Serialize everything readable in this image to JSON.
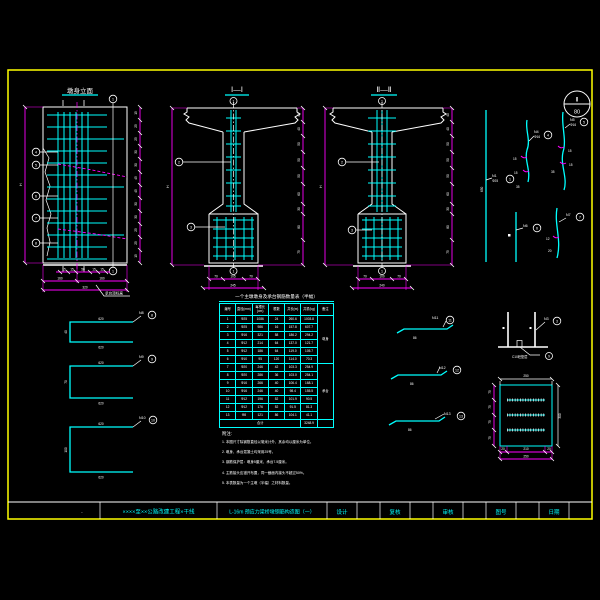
{
  "sheet": {
    "project": "××××至××公路改建工程×干线",
    "drawing_title": "L-16m 预应力梁桥墩钢筋构造图（一）",
    "fields": {
      "design": "设计",
      "check": "复核",
      "review": "审核",
      "fig_no": "图号",
      "date": "日期"
    },
    "corner_dot": "·",
    "detail_bubble": {
      "top": "Ⅱ",
      "bottom": "80"
    }
  },
  "elevation": {
    "title": "墩身立面",
    "height_label": "H",
    "callouts": [
      "4",
      "5",
      "6",
      "7",
      "8"
    ],
    "bar_circle": "1",
    "right_dims": [
      "15",
      "25",
      "25",
      "30",
      "30",
      "45",
      "45",
      "30",
      "30",
      "25",
      "25",
      "15"
    ],
    "bottom_dims_1": [
      "15",
      "15",
      "50",
      "15",
      "15"
    ],
    "bottom_dims_2": [
      "160",
      "160"
    ],
    "bottom_total": "320",
    "leader_note": "承台顶标高"
  },
  "section1": {
    "title": "Ⅰ—Ⅰ",
    "top_circle": "1",
    "bottom_circle": "1",
    "callout_column": "2",
    "callout_footing": "3",
    "height_label": "H",
    "right_dims": [
      "40",
      "40",
      "50",
      "50",
      "50",
      "60",
      "30",
      "80",
      "75"
    ],
    "bottom_dims": [
      "70",
      "105",
      "70"
    ],
    "bottom_total": "245"
  },
  "section2": {
    "title": "Ⅱ—Ⅱ",
    "top_circle": "1",
    "bottom_circle": "1",
    "callout_column": "2",
    "callout_footing": "3",
    "height_label": "H",
    "right_dims": [
      "40",
      "40",
      "50",
      "50",
      "50",
      "60",
      "30",
      "80",
      "75"
    ],
    "bottom_dims": [
      "70",
      "100",
      "70"
    ],
    "bottom_total": "240"
  },
  "bar_shapes": {
    "long_bar": {
      "name": "N1",
      "size": "Φ25",
      "length": "650",
      "num": "1"
    },
    "s_bar_1": {
      "name": "N4",
      "size": "Φ16",
      "num": "4",
      "hook1": "15",
      "hook2": "15",
      "seg": "35"
    },
    "s_bar_2": {
      "name": "N5",
      "size": "Φ16",
      "num": "5",
      "hook1": "15",
      "hook2": "15",
      "seg": "35"
    },
    "v_bar": {
      "name": "N6",
      "num": "6"
    },
    "c_bar": {
      "name": "N7",
      "num": "7",
      "dim1": "12",
      "dim2": "20"
    },
    "stirrup": {
      "name": "N3",
      "num": "3",
      "note": "C10砼垫层",
      "note_num": "9"
    },
    "hairpins": [
      {
        "name": "N8",
        "num": "8",
        "top": "620",
        "bottom": "620",
        "side": "40"
      },
      {
        "name": "N9",
        "num": "9",
        "top": "620",
        "bottom": "620",
        "side": "70"
      },
      {
        "name": "N10",
        "num": "10",
        "top": "620",
        "bottom": "620",
        "side": "100"
      }
    ],
    "flat_bars": [
      {
        "name": "N11",
        "num": "11",
        "dim": "86"
      },
      {
        "name": "N12",
        "num": "12",
        "dim": "86"
      },
      {
        "name": "N13",
        "num": "13",
        "dim": "86"
      }
    ]
  },
  "plan": {
    "top_dim": "250",
    "right_dim": "300",
    "left_dims": [
      "75",
      "75",
      "75",
      "75"
    ],
    "bottom_dims": [
      "20",
      "210",
      "20"
    ],
    "bottom_total": "250"
  },
  "table": {
    "title": "一个主墩墩身及承台钢筋数量表（半幅）",
    "headers": [
      "编号",
      "直径(mm)",
      "每根长(cm)",
      "根数",
      "共长(m)",
      "共重(kg)",
      "备注"
    ],
    "rows": [
      [
        "1",
        "Φ25",
        "1086",
        "24",
        "260.6",
        "1003.8"
      ],
      [
        "2",
        "Φ25",
        "986",
        "16",
        "157.8",
        "607.7"
      ],
      [
        "3",
        "Φ16",
        "321",
        "58",
        "186.2",
        "294.2"
      ],
      [
        "4",
        "Φ12",
        "214",
        "64",
        "137.0",
        "121.7"
      ],
      [
        "5",
        "Φ12",
        "186",
        "64",
        "119.0",
        "105.7"
      ],
      [
        "6",
        "Φ10",
        "95",
        "120",
        "114.0",
        "70.3"
      ],
      [
        "7",
        "Φ20",
        "246",
        "42",
        "103.3",
        "254.9"
      ],
      [
        "8",
        "Φ20",
        "286",
        "36",
        "103.0",
        "254.1"
      ],
      [
        "9",
        "Φ16",
        "266",
        "40",
        "106.4",
        "168.1"
      ],
      [
        "10",
        "Φ16",
        "246",
        "40",
        "98.4",
        "155.5"
      ],
      [
        "11",
        "Φ12",
        "196",
        "52",
        "101.9",
        "90.5"
      ],
      [
        "12",
        "Φ12",
        "176",
        "52",
        "91.5",
        "81.3"
      ],
      [
        "13",
        "Φ8",
        "121",
        "86",
        "104.1",
        "41.1"
      ]
    ],
    "remarks": [
      {
        "text": "墩身",
        "span": 6
      },
      {
        "text": "承台",
        "span": 7
      }
    ],
    "total_label": "合计",
    "total_value": "3248.9"
  },
  "notes": {
    "label": "附注:",
    "items": [
      "1. 本图尺寸除钢筋直径以毫米计外，其余均以厘米为单位。",
      "2. 墩身、承台混凝土均采用25号。",
      "3. 钢筋保护层：墩身5厘米，承台7.5厘米。",
      "4. 主筋接头应错开布置，同一截面内接头不超过50%。",
      "5. 本表数量为一个主墩（半幅）之材料数量。"
    ]
  }
}
